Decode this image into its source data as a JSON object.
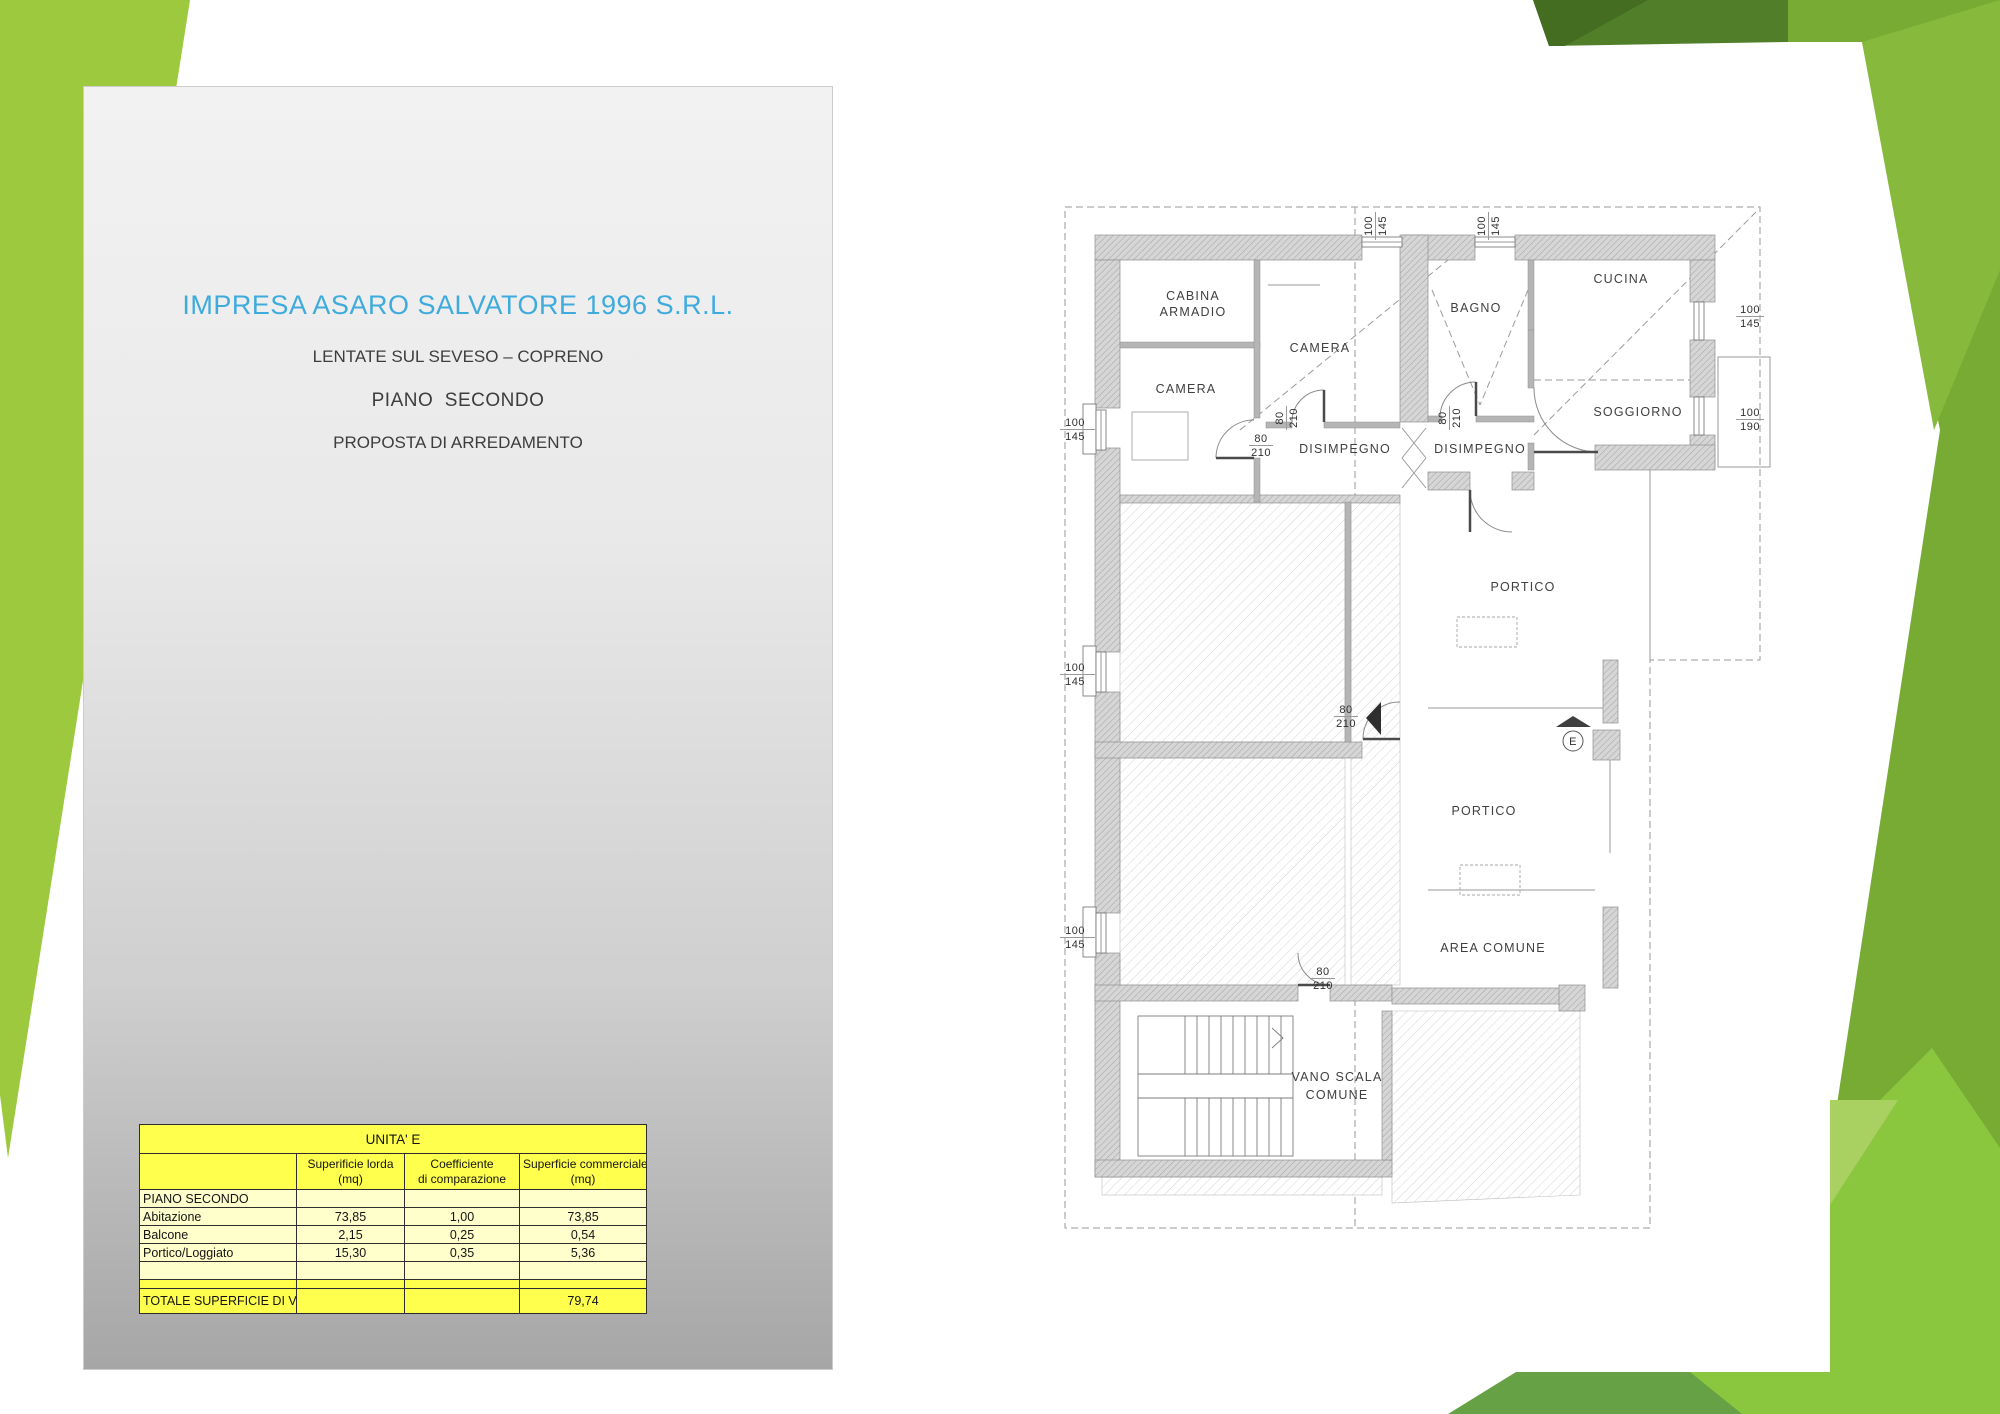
{
  "slide": {
    "company_title": "IMPRESA ASARO SALVATORE 1996 S.R.L.",
    "location": "LENTATE SUL SEVESO – COPRENO",
    "floor": "PIANO  SECONDO",
    "proposal": "PROPOSTA DI ARREDAMENTO",
    "accent_color": "#3fabdd"
  },
  "table": {
    "title": "UNITA'  E",
    "headers": [
      {
        "line1": "Superificie lorda",
        "line2": "(mq)"
      },
      {
        "line1": "Coefficiente",
        "line2": "di comparazione"
      },
      {
        "line1": "Superficie commerciale",
        "line2": "(mq)"
      }
    ],
    "rows": [
      {
        "label": "PIANO SECONDO",
        "lorda": "",
        "coeff": "",
        "comm": ""
      },
      {
        "label": "Abitazione",
        "lorda": "73,85",
        "coeff": "1,00",
        "comm": "73,85"
      },
      {
        "label": "Balcone",
        "lorda": "2,15",
        "coeff": "0,25",
        "comm": "0,54"
      },
      {
        "label": "Portico/Loggiato",
        "lorda": "15,30",
        "coeff": "0,35",
        "comm": "5,36"
      },
      {
        "label": "",
        "lorda": "",
        "coeff": "",
        "comm": ""
      }
    ],
    "total_label": "TOTALE SUPERFICIE DI VENDITA",
    "total_value": "79,74",
    "colors": {
      "bright_yellow": "#ffff4d",
      "light_yellow": "#ffffcc"
    }
  },
  "plan": {
    "rooms": {
      "cabina_line1": "CABINA",
      "cabina_line2": "ARMADIO",
      "camera_left": "CAMERA",
      "camera_center": "CAMERA",
      "bagno": "BAGNO",
      "cucina": "CUCINA",
      "soggiorno": "SOGGIORNO",
      "disimpegno_left": "DISIMPEGNO",
      "disimpegno_right": "DISIMPEGNO",
      "portico_upper": "PORTICO",
      "portico_lower": "PORTICO",
      "area_comune": "AREA COMUNE",
      "vano_scala_line1": "VANO SCALA",
      "vano_scala_line2": "COMUNE",
      "entrance": "E"
    },
    "dims": {
      "w100_145": {
        "top": "100",
        "bottom": "145"
      },
      "w100_190": {
        "top": "100",
        "bottom": "190"
      },
      "d80_210": {
        "top": "80",
        "bottom": "210"
      }
    }
  }
}
